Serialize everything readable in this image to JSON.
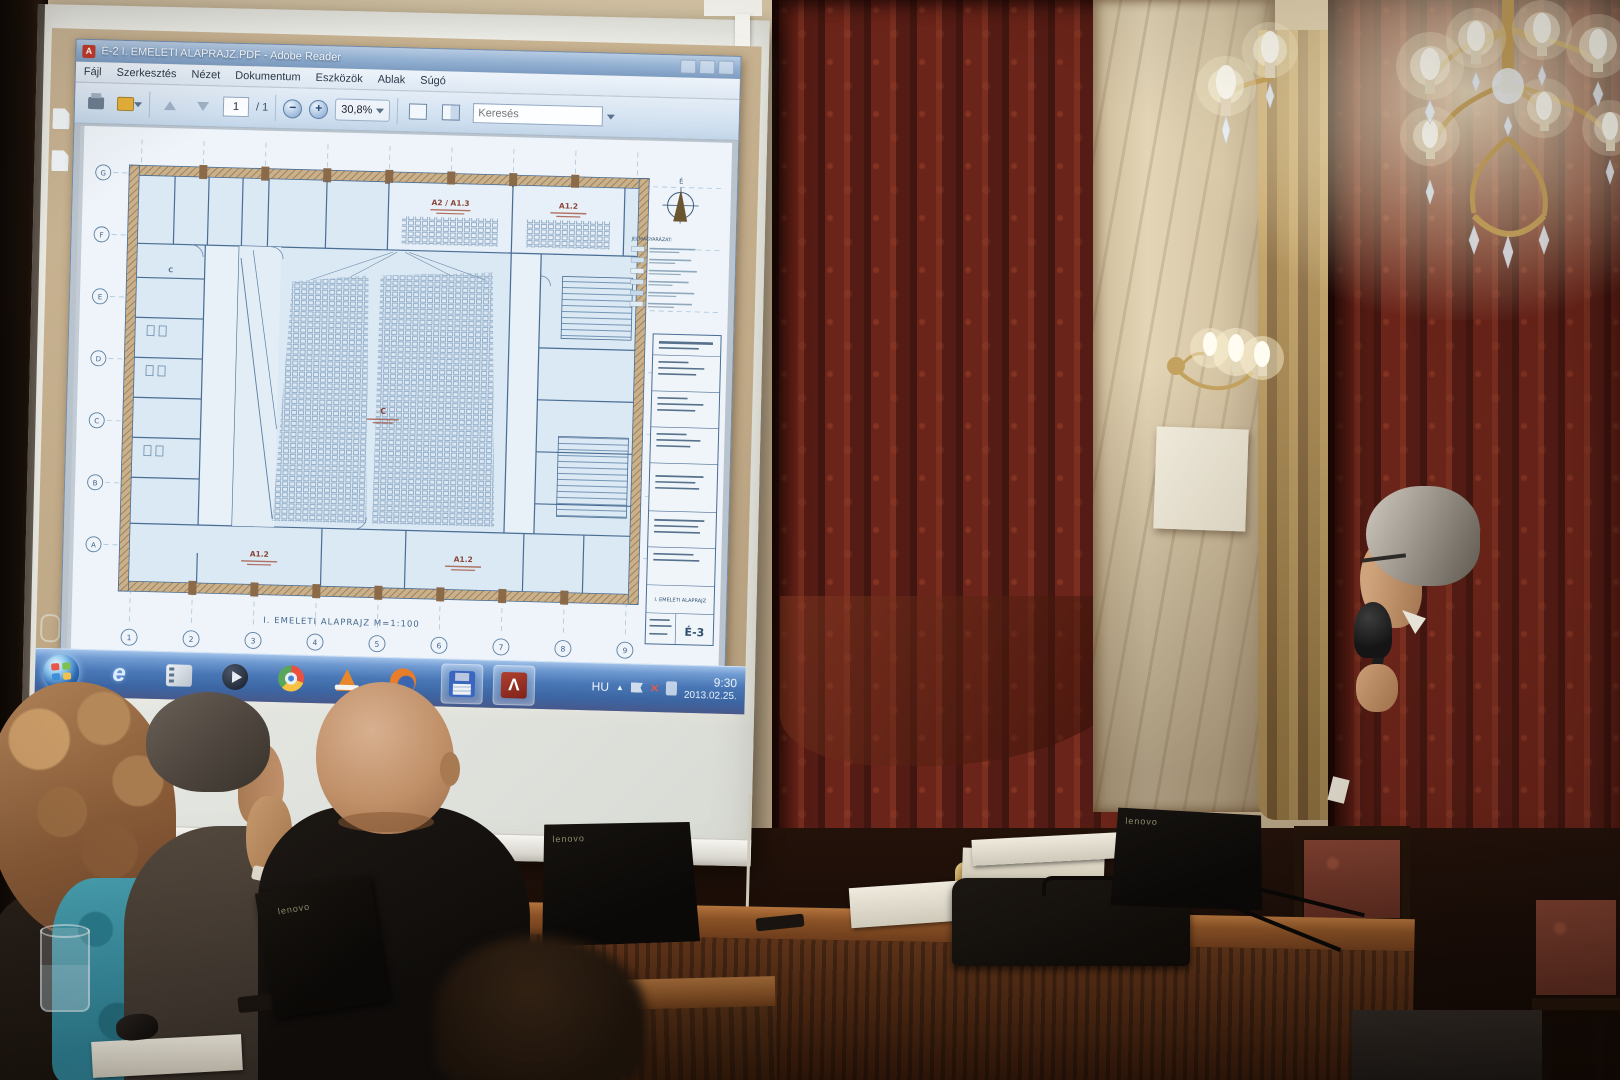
{
  "screen": {
    "window": {
      "title": "É-2 I. EMELETI ALAPRAJZ.PDF - Adobe Reader",
      "menus": [
        "Fájl",
        "Szerkesztés",
        "Nézet",
        "Dokumentum",
        "Eszközök",
        "Ablak",
        "Súgó"
      ],
      "toolbar": {
        "page_current": "1",
        "page_total": "/ 1",
        "zoom_level": "30,8%",
        "search_placeholder": "Keresés"
      }
    },
    "plan": {
      "caption": "I. EMELETI ALAPRAJZ   M=1:100",
      "sheet_code": "É-3",
      "sheet_title": "I. EMELETI ALAPRAJZ",
      "legend_title": "JELMAGYARÁZAT:",
      "north_label": "É",
      "room_labels": {
        "top_left": "A2 / A1.3",
        "top_right": "A1.2",
        "bottom_left": "A1.2",
        "bottom_center": "A1.2",
        "stage": "C"
      },
      "grid_numbers": [
        "1",
        "2",
        "3",
        "4",
        "5",
        "6",
        "7",
        "8",
        "9"
      ],
      "grid_letters": [
        "G",
        "F",
        "E",
        "D",
        "C",
        "B",
        "A"
      ],
      "legend_swatches": [
        "#dce8f2",
        "#cfe0ee",
        "#e8eef5",
        "#d4e2ef",
        "#c4d8ea",
        "#e2ebf4"
      ]
    },
    "taskbar": {
      "tray_language": "HU",
      "time": "9:30",
      "date": "2013.02.25."
    }
  },
  "room_scene": {
    "laptop_brand": "lenovo"
  },
  "colors": {
    "curtain": "#6b2419",
    "wall": "#c9b698",
    "taskbar_blue": "#4a77b4",
    "plan_line": "#4a6d94",
    "adobe_red": "#9c2e22"
  }
}
